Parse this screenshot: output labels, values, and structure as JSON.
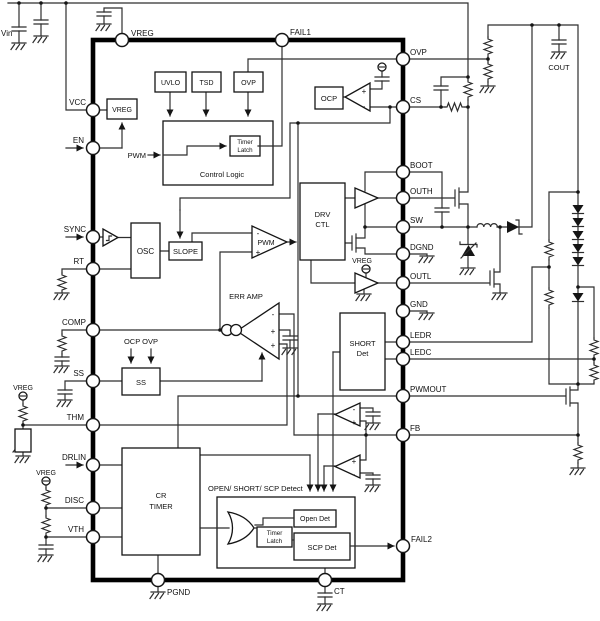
{
  "title": "Switching regulator LED driver IC block diagram",
  "pins": {
    "top": [
      "VREG",
      "FAIL1"
    ],
    "left": [
      "VCC",
      "EN",
      "SYNC",
      "RT",
      "COMP",
      "SS",
      "THM",
      "DRLIN",
      "DISC",
      "VTH"
    ],
    "right": [
      "OVP",
      "CS",
      "BOOT",
      "OUTH",
      "SW",
      "DGND",
      "OUTL",
      "GND",
      "LEDR",
      "LEDC",
      "PWMOUT",
      "FB",
      "FAIL2"
    ],
    "bottom": [
      "PGND",
      "CT"
    ]
  },
  "blocks": {
    "vreg": "VREG",
    "uvlo": "UVLO",
    "tsd": "TSD",
    "ovp": "OVP",
    "timer_l1": "Timer",
    "timer_l2": "Latch",
    "control_logic": "Control Logic",
    "pwm_in": "PWM",
    "ocp": "OCP",
    "osc": "OSC",
    "slope": "SLOPE",
    "pwm_comp": "PWM",
    "drv_l1": "DRV",
    "drv_l2": "CTL",
    "err_amp": "ERR AMP",
    "short_l1": "SHORT",
    "short_l2": "Det",
    "ss": "SS",
    "ss_inputs": "OCP OVP",
    "cr_l1": "CR",
    "cr_l2": "TIMER",
    "detect_title": "OPEN/ SHORT/ SCP Detect",
    "open_det": "Open Det",
    "scp_det": "SCP Det",
    "vreg_supply": "VREG"
  },
  "external": {
    "vin": "Vin",
    "cout": "COUT"
  },
  "signs": {
    "plus": "+",
    "minus": "-"
  },
  "colors": {
    "line": "#2e2e2e",
    "background": "#ffffff"
  }
}
